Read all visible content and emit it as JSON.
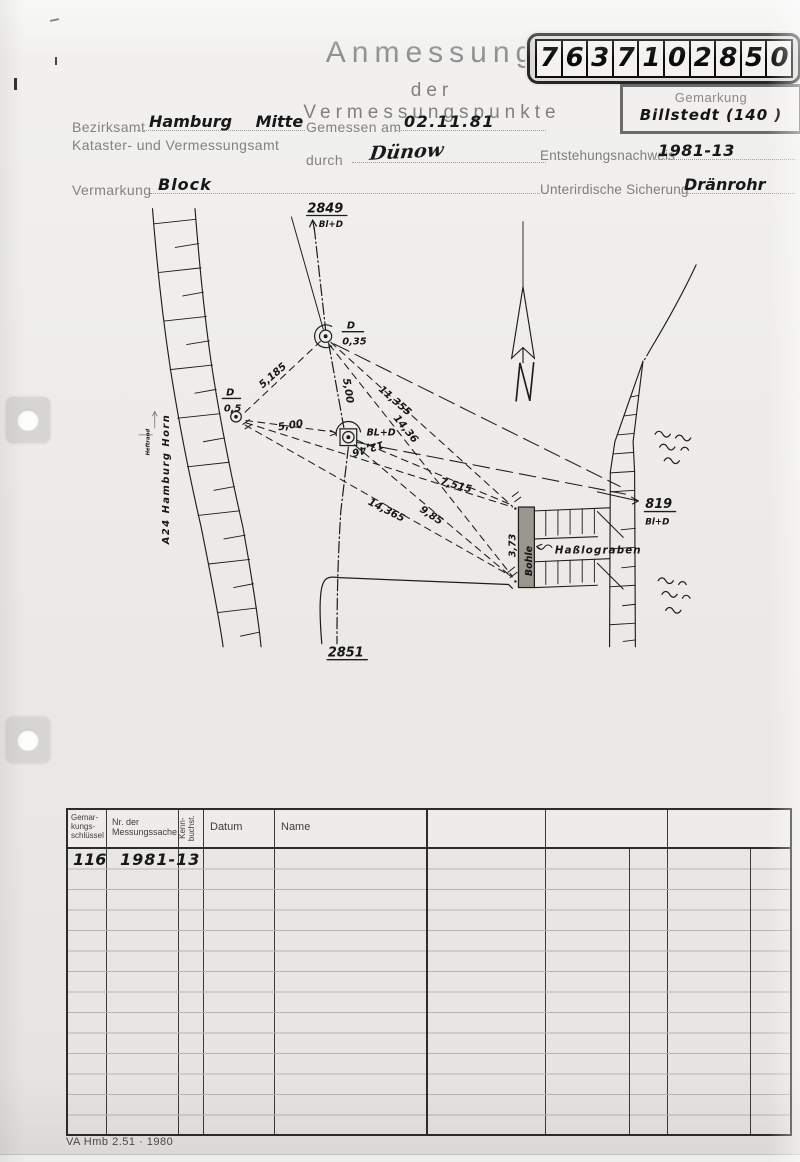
{
  "colors": {
    "paper": "#edebe7",
    "ink": "#1d1d1d",
    "print_gray": "#8a8a8a",
    "plank_gray": "#9a978f"
  },
  "header": {
    "title1": "Anmessung",
    "title2": "der Vermessungspunkte",
    "digits": [
      "7",
      "6",
      "3",
      "7",
      "1",
      "0",
      "2",
      "8",
      "5",
      "0"
    ],
    "gemarkung_label": "Gemarkung",
    "gemarkung_value": "Billstedt (140 )"
  },
  "form": {
    "bezirksamt_label": "Bezirksamt",
    "bezirksamt_value": "Hamburg Mitte",
    "amt_line2": "Kataster- und Vermessungsamt",
    "gemessen_label": "Gemessen am",
    "gemessen_value": "02.11.81",
    "durch_label": "durch",
    "durch_value": "Dünow",
    "vermarkung_label": "Vermarkung",
    "vermarkung_value": "Block",
    "entstehung_label": "Entstehungsnachweis",
    "entstehung_value": "1981-13",
    "sicherung_label": "Unterirdische Sicherung",
    "sicherung_value": "Dränrohr"
  },
  "sketch": {
    "heftrand": "Heftrand",
    "road": "A24 Hamburg Horn",
    "pt2849": "2849",
    "pt2849_type": "Bl+D",
    "pt2851": "2851",
    "pt819": "819",
    "pt819_type": "Bl+D",
    "a_top": "D",
    "a_bot": "0,5",
    "b_top": "D",
    "b_bot": "0,35",
    "c_label": "BL+D",
    "north": "N",
    "bohle": "Bohle",
    "bohle_w": "3,73",
    "graben": "Haßlograben",
    "m": [
      "5,185",
      "5,00",
      "11,355",
      "14,36",
      "5,00",
      "12,46",
      "7,515",
      "9,85",
      "14,365"
    ]
  },
  "table_left": {
    "h1": "Gemar-\nkungs-\nschlüssel",
    "h2": "Nr. der\nMessungssache",
    "h3": "Kenn-\nbuchst.",
    "h4": "Datum",
    "h5": "Name",
    "r1c1": "116",
    "r1c2": "1981-13"
  },
  "footer": {
    "text": "VA Hmb 2.51 · 1980"
  }
}
